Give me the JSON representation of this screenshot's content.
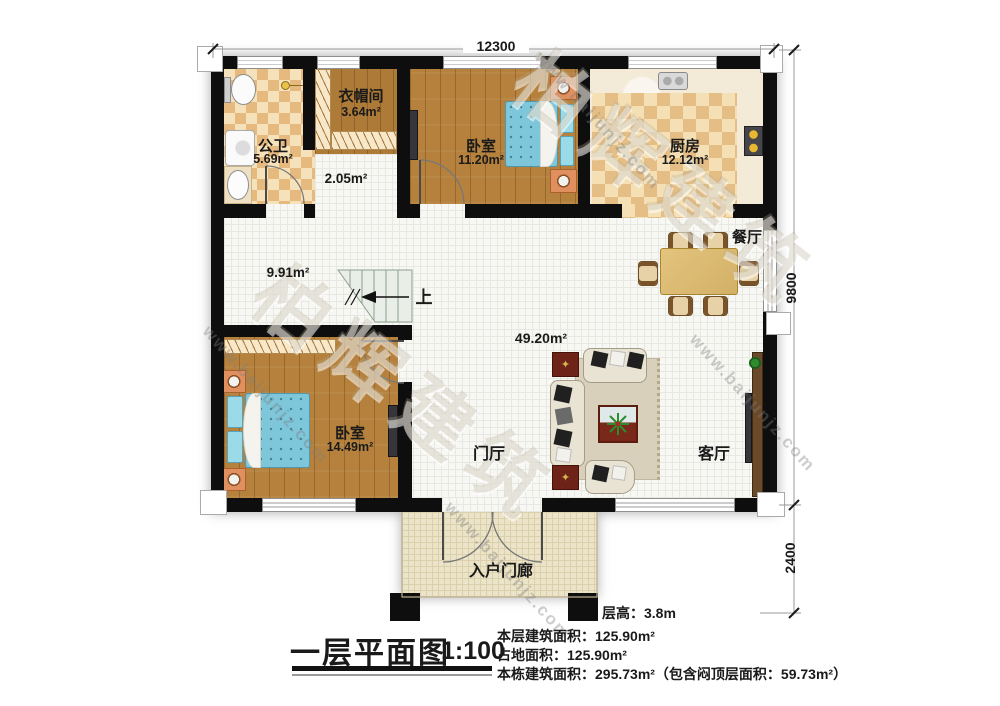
{
  "plan": {
    "dimensions": {
      "top": "12300",
      "right_upper": "9800",
      "right_lower": "2400"
    },
    "rooms": {
      "bathroom": {
        "name": "公卫",
        "area": "5.69m²"
      },
      "cloakroom": {
        "name": "衣帽间",
        "area": "3.64m²"
      },
      "corridor": {
        "area": "2.05m²"
      },
      "bedroom1": {
        "name": "卧室",
        "area": "11.20m²"
      },
      "kitchen": {
        "name": "厨房",
        "area": "12.12m²"
      },
      "dining": {
        "name": "餐厅"
      },
      "hall": {
        "area": "9.91m²"
      },
      "stairs": {
        "up_label": "上"
      },
      "living_open": {
        "area": "49.20m²"
      },
      "bedroom2": {
        "name": "卧室",
        "area": "14.49m²"
      },
      "foyer": {
        "name": "门厅"
      },
      "living": {
        "name": "客厅"
      },
      "porch": {
        "name": "入户门廊"
      }
    },
    "watermark": {
      "brand": "柏辉建筑",
      "url": "www.baijunjz.com"
    },
    "colors": {
      "wall": "#0e0e0e",
      "wood": "#b5813c",
      "tile_tan": "#e6ba7e",
      "bed_blue": "#7ec6da"
    }
  },
  "titleblock": {
    "title": "一层平面图",
    "scale": "1:100",
    "floor_height": "层高：3.8m",
    "stats": [
      "本层建筑面积：125.90m²",
      "占地面积：125.90m²",
      "本栋建筑面积：295.73m²（包含闷顶层面积：59.73m²）"
    ]
  }
}
